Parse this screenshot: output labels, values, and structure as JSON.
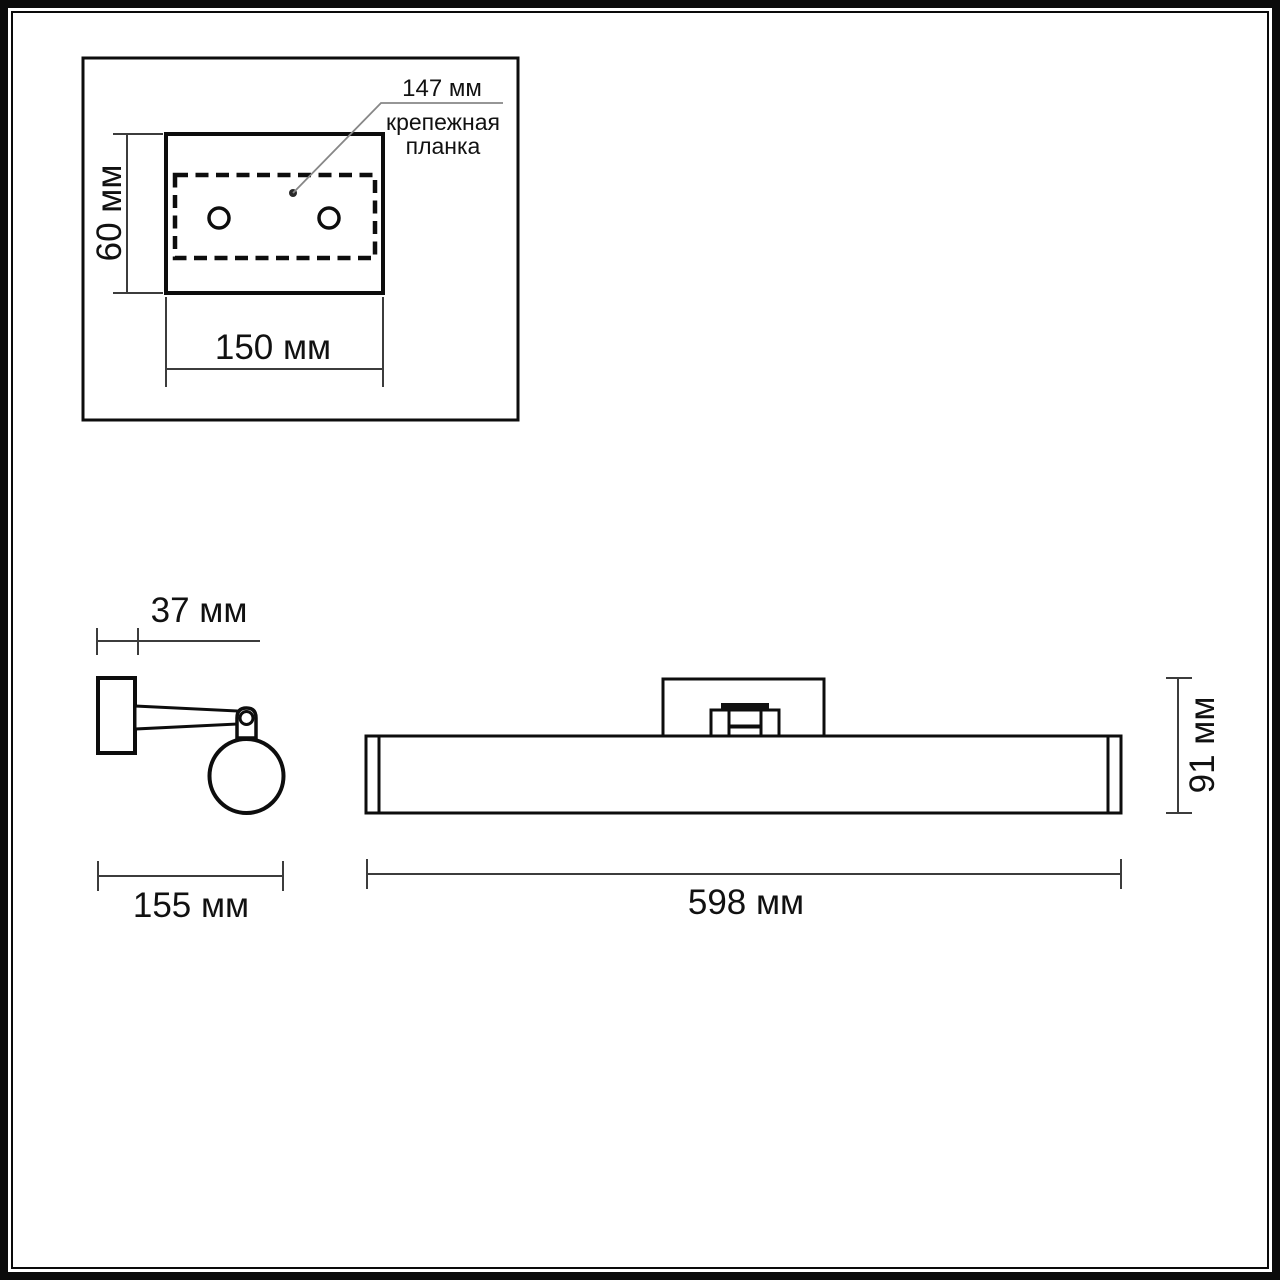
{
  "drawing": {
    "inset": {
      "bar_span_label": "147 мм",
      "bar_caption_line1": "крепежная",
      "bar_caption_line2": "планка",
      "plate_height_label": "60 мм",
      "plate_width_label": "150 мм"
    },
    "side_view": {
      "wall_plate_depth_label": "37 мм",
      "total_depth_label": "155 мм"
    },
    "front_view": {
      "total_width_label": "598 мм",
      "total_height_label": "91 мм"
    },
    "colors": {
      "outline": "#0d0d0d",
      "dimension_line": "#3c3c3c",
      "leader_line": "#878787",
      "background": "#ffffff"
    }
  }
}
